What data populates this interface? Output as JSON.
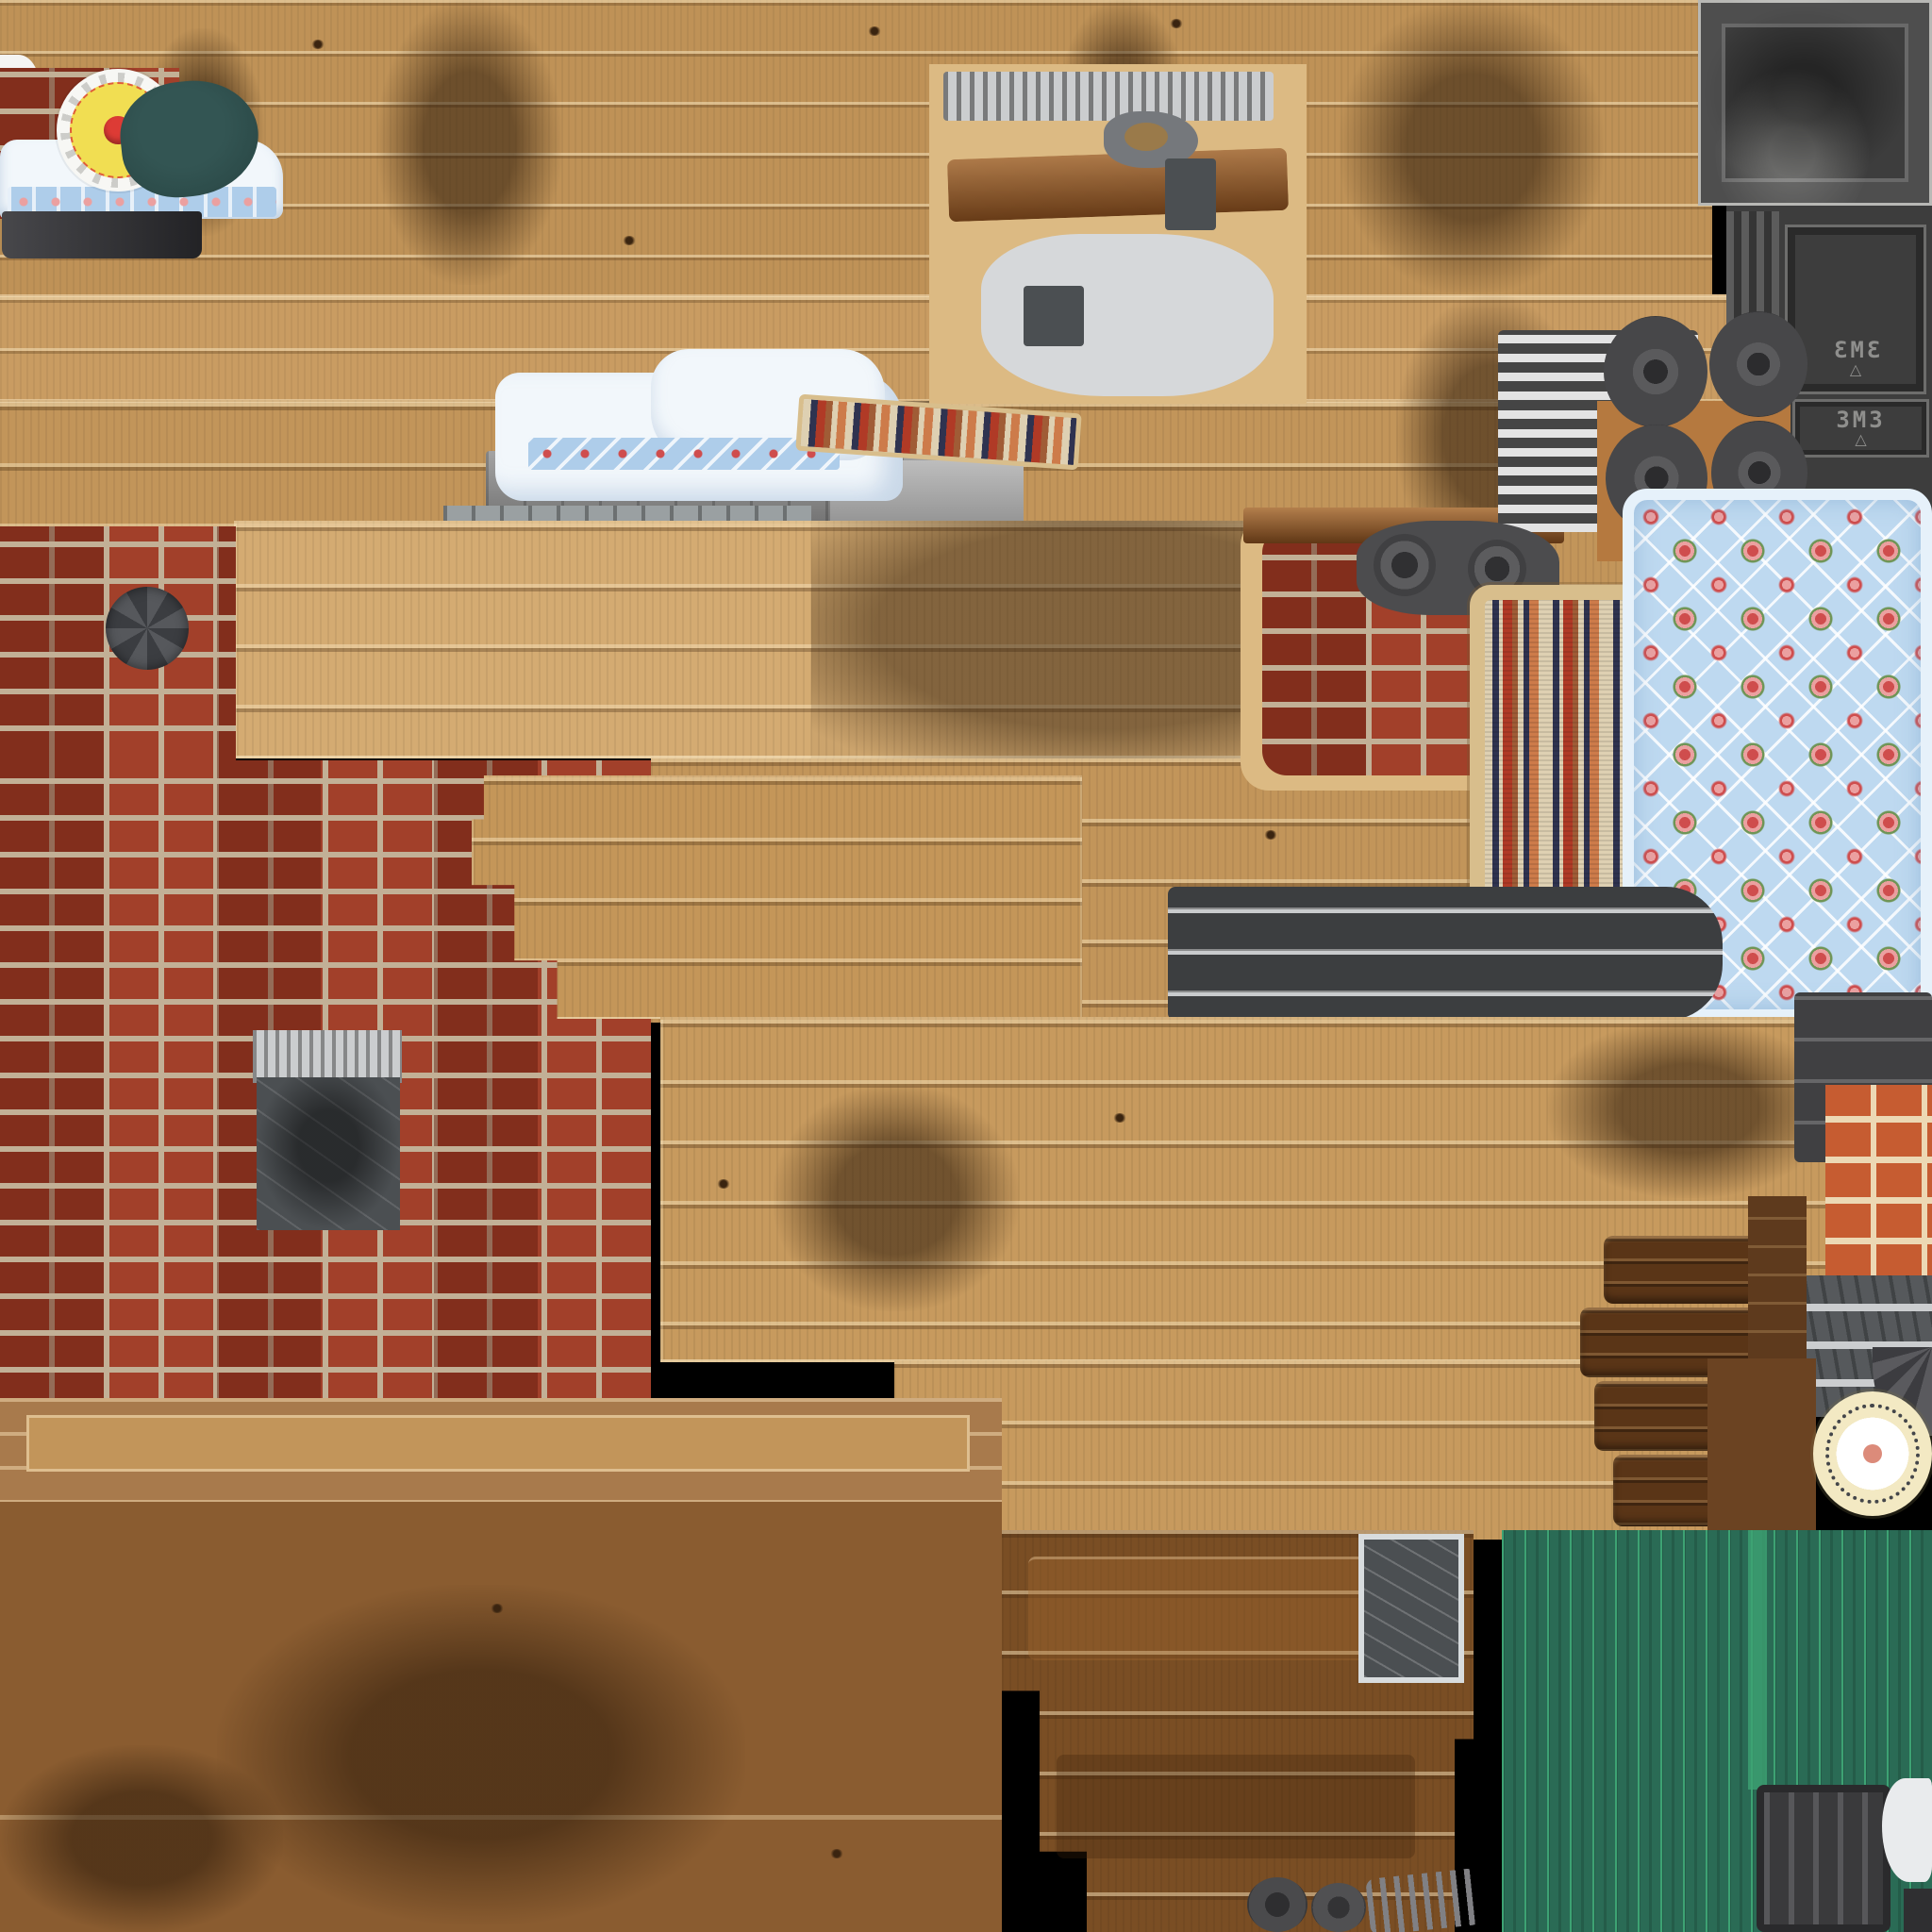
{
  "labels": {
    "crate_marking": "3M3",
    "crate_symbol": "△"
  },
  "palette": {
    "woodTop": "#bf9257",
    "woodBand": "#c99c62",
    "woodBand3": "#c2955a",
    "woodOverlay": "#d4ab72",
    "woodCenter": "#c49659",
    "woodLower": "#c79a5e",
    "woodBottomBand": "#a87a4c",
    "woodBottomPanel": "#8a5c30",
    "woodBottomMid": "#7a4e24",
    "woodDarkBlocks": "#5a3517",
    "beamBrown": "#8a4f1f",
    "metalBgWood": "#dcba83",
    "brickRed": "#a2402a",
    "brickMortar": "#c2b096",
    "brickOrange": "#c65c31",
    "brickOrangeMortar": "#ecd8b4",
    "crateDark": "#3d3d3d",
    "metalLight": "#cbcdcf",
    "metalPale": "#d6d8da",
    "metalPlateDark": "#4b4f52",
    "threshold": "#3c3e40",
    "thresholdStripe": "#c9cbcd",
    "green": "#2a6b55",
    "greenLine": "#3da273",
    "quiltBg": "#bed9f0",
    "quiltEdge": "#e6f1fa",
    "rose": "#cf4d4d",
    "roseLight": "#eba0a0",
    "leaf": "#6f9556",
    "rugFringe": "#d8be8c",
    "rugCream": "#ded0b2",
    "rugNavy": "#2f3350",
    "rugRed": "#b03a26",
    "rugRust": "#a05c36",
    "rugOrange": "#cd7b4a",
    "beddingWhite": "#f2f7fb",
    "beddingHem": "#aecdea",
    "tealCushion": "#2c4b49",
    "rosetteYellow": "#f1de52",
    "rosetteRed": "#dd3b35",
    "rosetteWhite": "#f7f7f4",
    "plateCream": "#f3e9c3",
    "plateSalmon": "#dc8b7a",
    "zebraLight": "#e3e3e3",
    "zebraDark": "#454545"
  },
  "regions": [
    {
      "name": "wood-plank-band-top",
      "material": "light stained wood planks with soot streaks"
    },
    {
      "name": "ammo-crate-lid",
      "material": "dark scratched metal crate lid"
    },
    {
      "name": "ammo-crate-front",
      "material": "dark crate panel stenciled 3M3 with triangle"
    },
    {
      "name": "ammo-crate-side",
      "material": "dark crate panel stenciled 3M3 with triangle"
    },
    {
      "name": "bed-scene-small",
      "material": "white floral bedding, yellow rosette cushion, teal cushion, brick patch"
    },
    {
      "name": "metal-parts-cluster",
      "material": "grey machined plates, brown beam, brackets"
    },
    {
      "name": "bed-scene-large",
      "material": "white bedding with blue floral hem, pillow, grey metal base, rug fragment"
    },
    {
      "name": "brick-wall-left",
      "material": "red brick with pale mortar, pinwheel vent, scratched metal plate"
    },
    {
      "name": "wood-overlay-panel",
      "material": "light wood planks with dark stain"
    },
    {
      "name": "stepped-wood-planks",
      "material": "mid-tone stepped plank tiers"
    },
    {
      "name": "brick-patch-mid",
      "material": "red brick cross patch"
    },
    {
      "name": "machine-wheels",
      "material": "grey oval wheels with hub keyholes on orange backing"
    },
    {
      "name": "striped-metal-beams",
      "material": "zebra striped light/dark metal beams"
    },
    {
      "name": "rag-rug",
      "material": "woven stripe rug, red/navy/cream with tan fringe"
    },
    {
      "name": "floral-quilt",
      "material": "light blue quilt, white diamond lattice, rose clusters, ruffled edge"
    },
    {
      "name": "metal-threshold",
      "material": "dark panel with horizontal bright ridges"
    },
    {
      "name": "wood-panel-lower-mid",
      "material": "light wood planks with stepped edges"
    },
    {
      "name": "dark-wood-blocks",
      "material": "stacked dark brown timber bars"
    },
    {
      "name": "chimney-column",
      "material": "dark segmented column, orange brick column, banded metal base"
    },
    {
      "name": "enamel-plate-clock",
      "material": "white plate, cream rim, dotted ring, salmon center"
    },
    {
      "name": "corrugated-green-wall",
      "material": "teal-green corrugated metal with bright seams"
    },
    {
      "name": "ridged-metal-crate",
      "material": "dark grey ridged panel in green zone"
    },
    {
      "name": "wood-band-bottom",
      "material": "mid brown plank band with light inset"
    },
    {
      "name": "plywood-panel-bottom-left",
      "material": "dark brown wood sheet with soot smudge"
    },
    {
      "name": "dark-plank-steps-bottom",
      "material": "dark stepped plank tiers with bordered grey plate"
    },
    {
      "name": "wheel-discs-and-springs",
      "material": "small dark discs and grey coil springs"
    }
  ]
}
